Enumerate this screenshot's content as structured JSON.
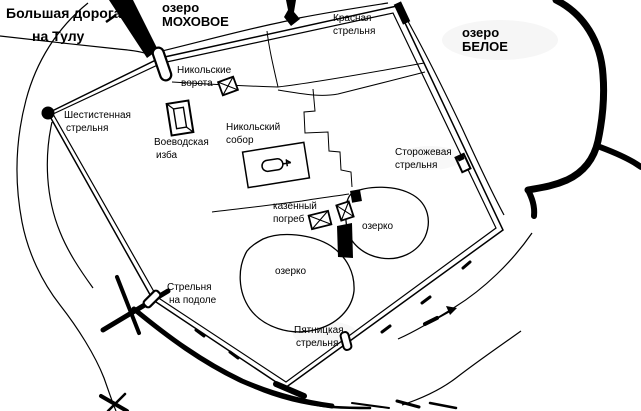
{
  "map": {
    "colors": {
      "ink": "#000000",
      "paper": "#ffffff"
    },
    "icons": {
      "gate": "capsule-outline",
      "wall_tower": "small-white-rect",
      "corner_tower": "filled-circle",
      "building": "rect-with-diagonals",
      "church": "oval-with-cross-arrow",
      "direction_arrow": "ne-arrow"
    },
    "labels": {
      "road": {
        "line1": "Большая дорога",
        "line2": "на Тулу"
      },
      "lake_mokhovoye": {
        "line1": "озеро",
        "line2": "МОХОВОЕ"
      },
      "lake_beloye": {
        "line1": "озеро",
        "line2": "БЕЛОЕ"
      },
      "krasnaya": {
        "line1": "Красная",
        "line2": "стрельня"
      },
      "nikolskie_vorota": {
        "line1": "Никольские",
        "line2": "ворота"
      },
      "shestistennaya": {
        "line1": "Шестистенная",
        "line2": "стрельня"
      },
      "voevodskaya": {
        "line1": "Воеводская",
        "line2": "изба"
      },
      "nikolsky_sobor": {
        "line1": "Никольский",
        "line2": "собор"
      },
      "storozhevaya": {
        "line1": "Сторожевая",
        "line2": "стрельня"
      },
      "kazenny_pogreb": {
        "line1": "казенный",
        "line2": "погреб"
      },
      "ozerko_east": "озерко",
      "ozerko_west": "озерко",
      "strelnya_na_podole": {
        "line1": "Стрельня",
        "line2": "на подоле"
      },
      "pyatnitskaya": {
        "line1": "Пятницкая",
        "line2": "стрельня"
      }
    }
  }
}
